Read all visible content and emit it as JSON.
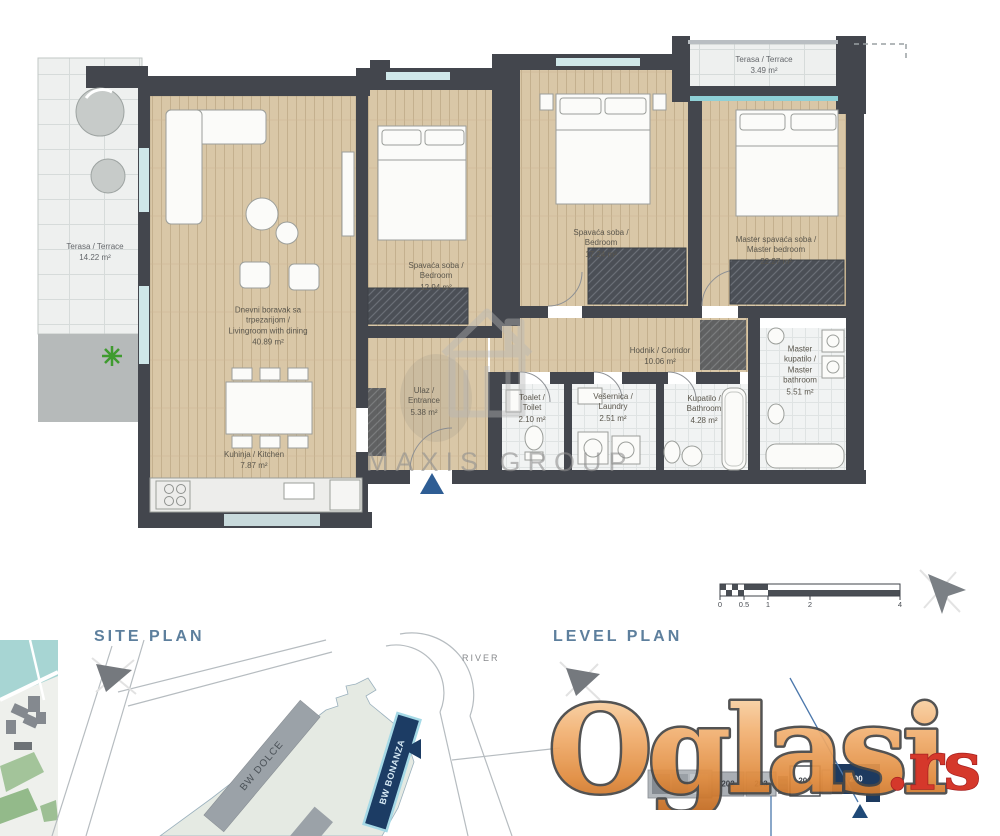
{
  "floor_plan": {
    "rooms": [
      {
        "id": "terrace-left",
        "label": "Terasa / Terrace",
        "area": "14.22 m²"
      },
      {
        "id": "living-room",
        "label": "Dnevni boravak sa\ntrpezarijom /\nLivingroom with dining",
        "area": "40.89 m²"
      },
      {
        "id": "bedroom-1",
        "label": "Spavaća soba /\nBedroom",
        "area": "12.94 m²"
      },
      {
        "id": "bedroom-2",
        "label": "Spavaća soba /\nBedroom",
        "area": "17.24 m²"
      },
      {
        "id": "master-bedroom",
        "label": "Master spavaća soba /\nMaster bedroom",
        "area": "22.27 m²"
      },
      {
        "id": "corridor",
        "label": "Hodnik / Corridor",
        "area": "10.06 m²"
      },
      {
        "id": "entrance",
        "label": "Ulaz /\nEntrance",
        "area": "5.38 m²"
      },
      {
        "id": "toilet",
        "label": "Toalet /\nToilet",
        "area": "2.10 m²"
      },
      {
        "id": "laundry",
        "label": "Vešernica /\nLaundry",
        "area": "2.51 m²"
      },
      {
        "id": "bathroom",
        "label": "Kupatilo /\nBathroom",
        "area": "4.28 m²"
      },
      {
        "id": "master-bathroom",
        "label": "Master\nkupatilo /\nMaster\nbathroom",
        "area": "5.51 m²"
      },
      {
        "id": "kitchen",
        "label": "Kuhinja / Kitchen",
        "area": "7.87 m²"
      },
      {
        "id": "terrace-top",
        "label": "Terasa / Terrace",
        "area": "3.49 m²"
      }
    ]
  },
  "scale_bar": {
    "ticks": [
      "0",
      "0.5",
      "1",
      "2",
      "4"
    ]
  },
  "watermarks": {
    "agency": "MAXIS GROUP",
    "portal_name": "Oglasi",
    "portal_suffix": ".rs"
  },
  "site_plan": {
    "title": "SITE PLAN",
    "river": "RIVER",
    "buildings": [
      "BW DOLCE",
      "BW BONANZA"
    ]
  },
  "level_plan": {
    "title": "LEVEL PLAN",
    "units": [
      "202",
      "203",
      "201",
      "200"
    ],
    "highlighted_unit": "200"
  },
  "colors": {
    "wall": "#43464d",
    "wood": "#d9c7a7",
    "navy": "#1d3a5f",
    "accent_orange": "#e8913f",
    "heading_blue": "#5d7f9d",
    "portal_red": "#d2291b",
    "teal_window": "#8fd0d6"
  }
}
